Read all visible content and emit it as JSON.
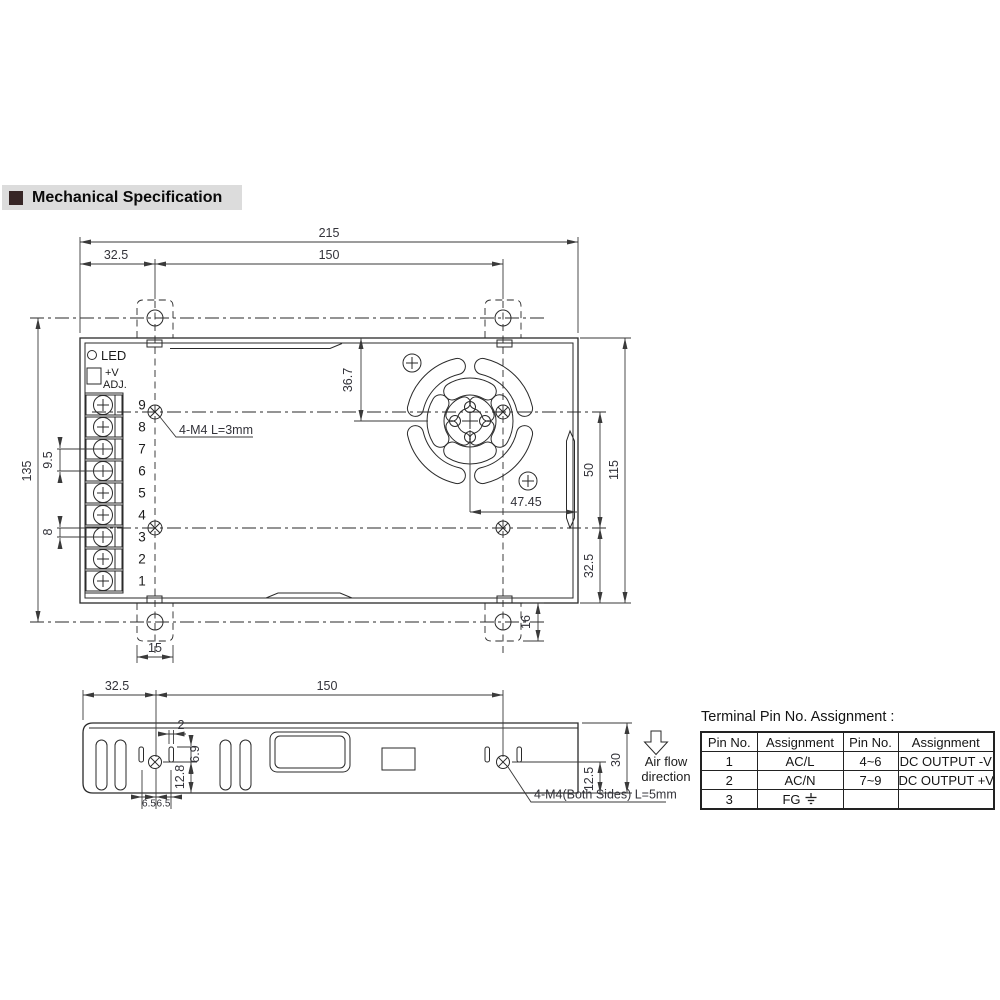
{
  "heading": {
    "text": "Mechanical Specification"
  },
  "top_view": {
    "dim_215": "215",
    "dim_32_5_left": "32.5",
    "dim_150": "150",
    "dim_135": "135",
    "dim_9_5": "9.5",
    "dim_8": "8",
    "dim_36_7": "36.7",
    "dim_47_45": "47.45",
    "dim_50": "50",
    "dim_115": "115",
    "dim_32_5_right": "32.5",
    "dim_16": "16",
    "dim_15": "15",
    "led_label": "LED",
    "adj_label_1": "+V",
    "adj_label_2": "ADJ.",
    "terminal_numbers": [
      "9",
      "8",
      "7",
      "6",
      "5",
      "4",
      "3",
      "2",
      "1"
    ],
    "mounting_note": "4-M4 L=3mm"
  },
  "side_view": {
    "dim_32_5": "32.5",
    "dim_150": "150",
    "dim_2": "2",
    "dim_6_9": "6.9",
    "dim_12_8": "12.8",
    "dim_6_5_a": "6.5",
    "dim_6_5_b": "6.5",
    "dim_12_5": "12.5",
    "dim_30": "30",
    "mounting_note": "4-M4(Both Sides) L=5mm"
  },
  "airflow": {
    "line1": "Air flow",
    "line2": "direction"
  },
  "pin_table": {
    "title": "Terminal Pin No. Assignment :",
    "headers": [
      "Pin No.",
      "Assignment",
      "Pin No.",
      "Assignment"
    ],
    "rows": [
      [
        "1",
        "AC/L",
        "4~6",
        "DC OUTPUT -V"
      ],
      [
        "2",
        "AC/N",
        "7~9",
        "DC OUTPUT +V"
      ],
      [
        "3",
        "FG",
        "",
        ""
      ]
    ]
  },
  "colors": {
    "line": "#2a2a2a",
    "dim_text": "#33333a",
    "heading_bg": "#dcdcdc",
    "heading_square": "#362525"
  }
}
